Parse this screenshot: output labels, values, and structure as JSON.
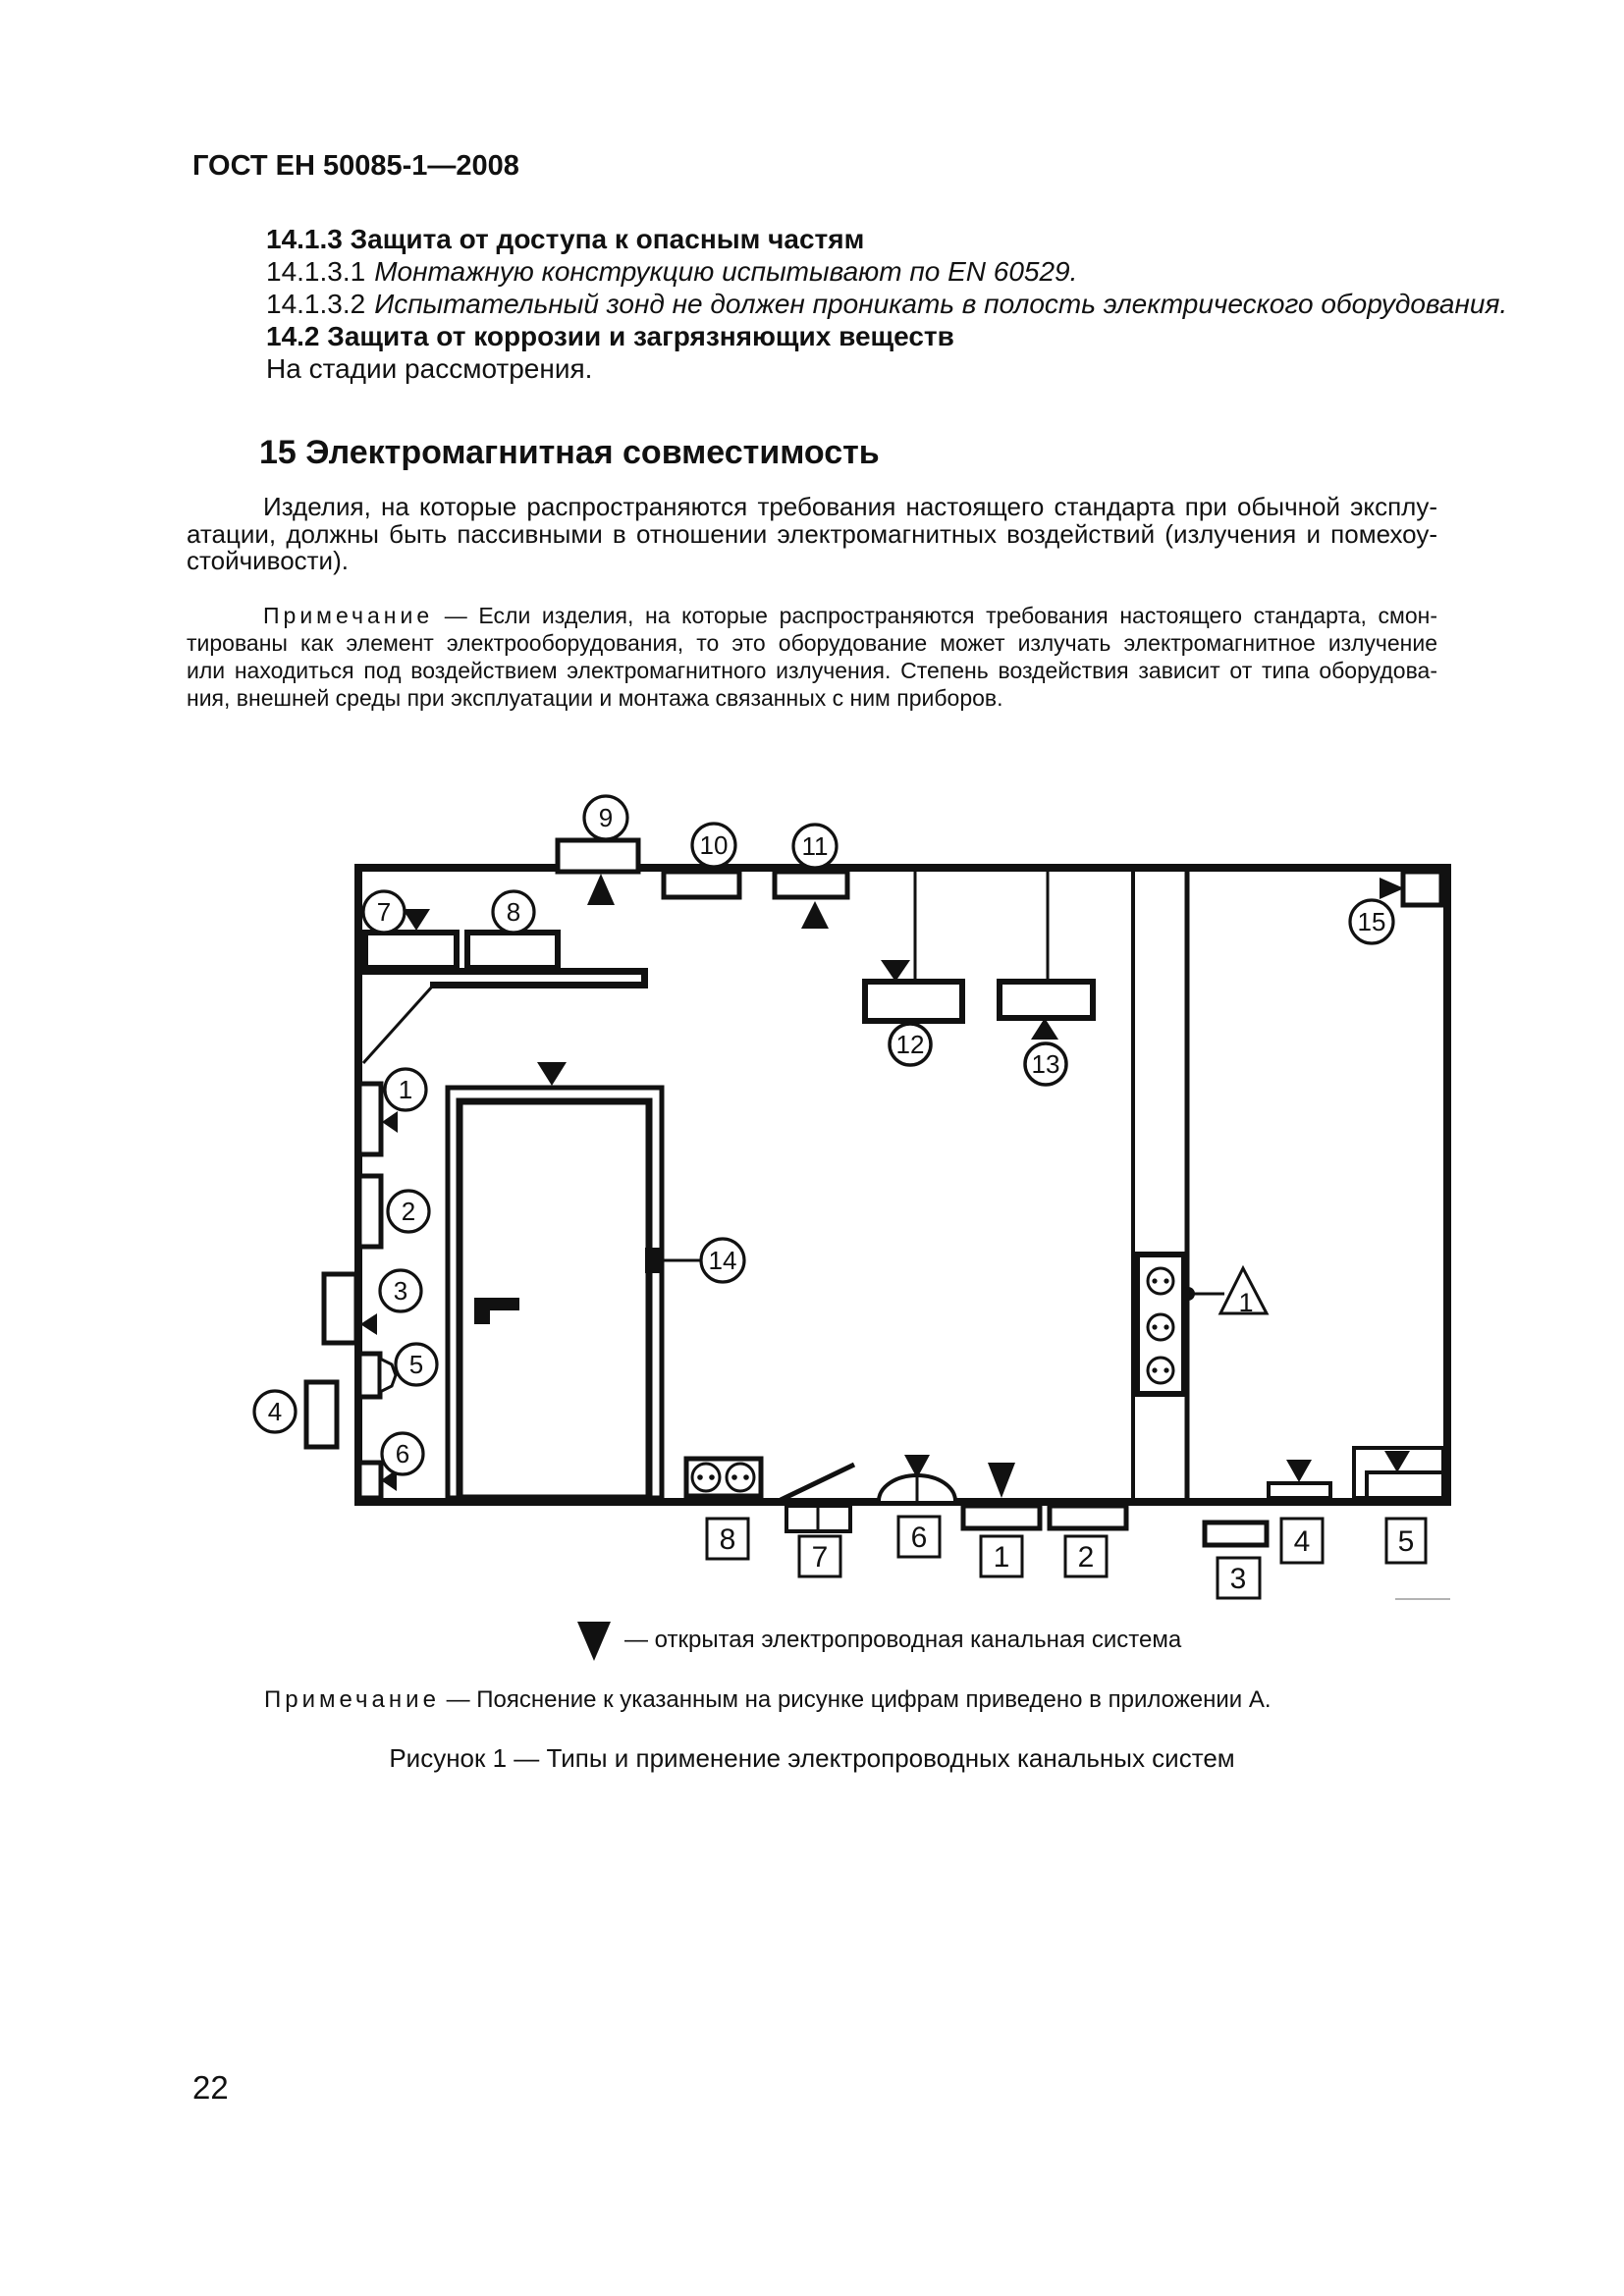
{
  "page": {
    "header": "ГОСТ ЕН 50085-1—2008",
    "page_number": "22"
  },
  "sections": {
    "s1413_title": "14.1.3 Защита от доступа к опасным частям",
    "s14131": {
      "num": "14.1.3.1",
      "text": "Монтажную конструкцию испытывают по EN 60529."
    },
    "s14132": {
      "num": "14.1.3.2",
      "text": "Испытательный зонд не должен проникать в полость электрического оборудования."
    },
    "s142_title": "14.2 Защита от коррозии и загрязняющих веществ",
    "s142_status": "На стадии рассмотрения.",
    "s15_title": "15 Электромагнитная совместимость"
  },
  "paragraph": {
    "lines": [
      "Изделия, на которые распространяются требования настоящего стандарта при обычной эксплу-",
      "атации, должны быть пассивными в отношении электромагнитных воздействий (излучения и помехоу-",
      "стойчивости)."
    ]
  },
  "note": {
    "label": "Примечание",
    "line1_rest": " — Если изделия, на которые распространяются требования настоящего стандарта, смон-",
    "lines": [
      "тированы как элемент электрооборудования, то это оборудование может излучать электромагнитное излучение",
      "или находиться под воздействием электромагнитного излучения. Степень воздействия зависит от типа оборудова-",
      "ния, внешней среды при эксплуатации и монтажа связанных с ним приборов."
    ]
  },
  "figure": {
    "legend_text": "— открытая электропроводная канальная система",
    "note_label": "Примечание",
    "note_text": " — Пояснение к указанным на рисунке цифрам приведено в приложении А.",
    "caption": "Рисунок 1 — Типы и применение электропроводных канальных систем",
    "circles": {
      "c1": "1",
      "c2": "2",
      "c3": "3",
      "c4": "4",
      "c5": "5",
      "c6": "6",
      "c7": "7",
      "c8": "8",
      "c9": "9",
      "c10": "10",
      "c11": "11",
      "c12": "12",
      "c13": "13",
      "c14": "14",
      "c15": "15"
    },
    "squares": {
      "s1": "1",
      "s2": "2",
      "s3": "3",
      "s4": "4",
      "s5": "5",
      "s6": "6",
      "s7": "7",
      "s8": "8"
    },
    "warning_label": "1"
  }
}
